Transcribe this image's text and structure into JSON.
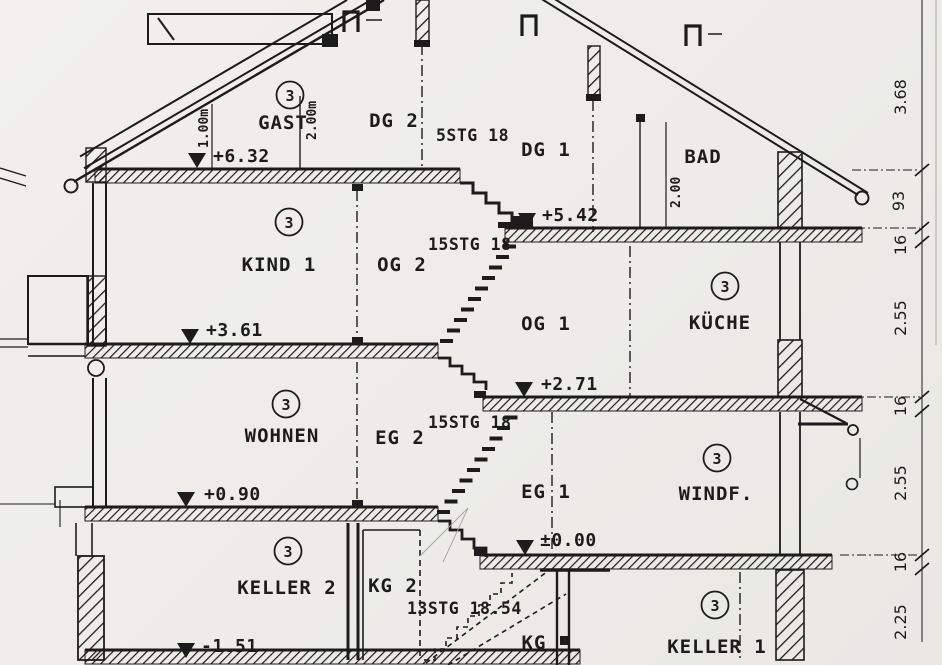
{
  "meta": {
    "kind": "Scanned architectural building cross-section drawing"
  },
  "unit_badge": "3",
  "rooms": {
    "gast": "GAST",
    "dg2": "DG 2",
    "dg1": "DG 1",
    "bad": "BAD",
    "kind1": "KIND 1",
    "og2": "OG 2",
    "og1": "OG 1",
    "kueche": "KÜCHE",
    "wohnen": "WOHNEN",
    "eg2": "EG 2",
    "eg1": "EG 1",
    "windf": "WINDF.",
    "keller2": "KELLER 2",
    "kg2": "KG 2",
    "kg": "KG",
    "keller1": "KELLER 1"
  },
  "levels": {
    "dg2_floor": "+6.32",
    "dg1_floor": "+5.42",
    "og2_floor": "+3.61",
    "og1_floor": "+2.71",
    "eg2_floor": "+0.90",
    "eg1_floor": "±0.00",
    "keller2_floor": "-1.51"
  },
  "stairs": {
    "dg": "5STG 18",
    "og": "15STG 18",
    "eg": "15STG 18",
    "kg": "13STG 18.54"
  },
  "height_marks": {
    "knee_wall": "1.00m",
    "gast_height": "2.00m",
    "bad_height": "2.00"
  },
  "dimension_chain": [
    "3.68",
    "93",
    "16",
    "2.55",
    "16",
    "2.55",
    "16",
    "2.25"
  ],
  "colors": {
    "ink": "#1c1c1c",
    "paper": "#efeeea"
  }
}
